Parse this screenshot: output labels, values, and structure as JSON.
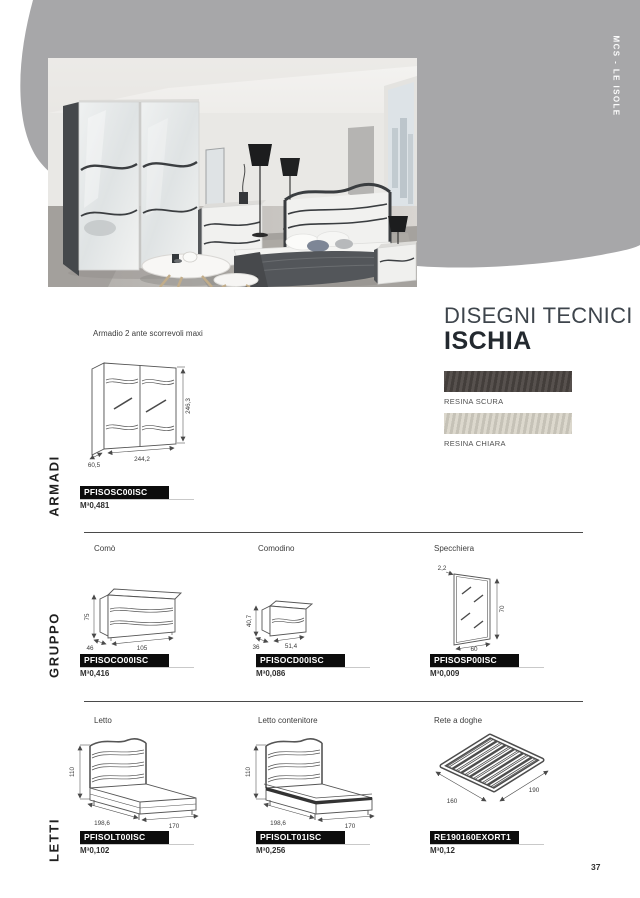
{
  "page": {
    "number": "37",
    "side_label": "MCS - LE ISOLE"
  },
  "tech_header": {
    "line1": "DISEGNI TECNICI",
    "line2": "ISCHIA"
  },
  "finishes": [
    {
      "name": "RESINA SCURA",
      "color": "#4a4441"
    },
    {
      "name": "RESINA CHIARA",
      "color": "#d9d5c9"
    }
  ],
  "volume_unit": "M³",
  "sections": [
    {
      "label": "ARMADI",
      "items": [
        {
          "title": "Armadio 2 ante scorrevoli maxi",
          "code": "PFISOSC00ISC",
          "volume": "0,481",
          "dims": {
            "height": "246,3",
            "width": "244,2",
            "depth": "60,5"
          }
        }
      ]
    },
    {
      "label": "GRUPPO",
      "items": [
        {
          "title": "Comò",
          "code": "PFISOCO00ISC",
          "volume": "0,416",
          "dims": {
            "height": "75",
            "width": "105",
            "depth": "46"
          }
        },
        {
          "title": "Comodino",
          "code": "PFISOCD00ISC",
          "volume": "0,086",
          "dims": {
            "height": "40,7",
            "width": "51,4",
            "depth": "36"
          }
        },
        {
          "title": "Specchiera",
          "code": "PFISOSP00ISC",
          "volume": "0,009",
          "dims": {
            "height": "70",
            "width": "60",
            "depth": "2,2"
          }
        }
      ]
    },
    {
      "label": "LETTI",
      "items": [
        {
          "title": "Letto",
          "code": "PFISOLT00ISC",
          "volume": "0,102",
          "dims": {
            "height": "110",
            "width": "170",
            "depth": "198,6"
          }
        },
        {
          "title": "Letto contenitore",
          "code": "PFISOLT01ISC",
          "volume": "0,256",
          "dims": {
            "height": "110",
            "width": "170",
            "depth": "198,6"
          }
        },
        {
          "title": "Rete a doghe",
          "code": "RE190160EXORT1",
          "volume": "0,12",
          "dims": {
            "width": "190",
            "depth": "160"
          }
        }
      ]
    }
  ]
}
